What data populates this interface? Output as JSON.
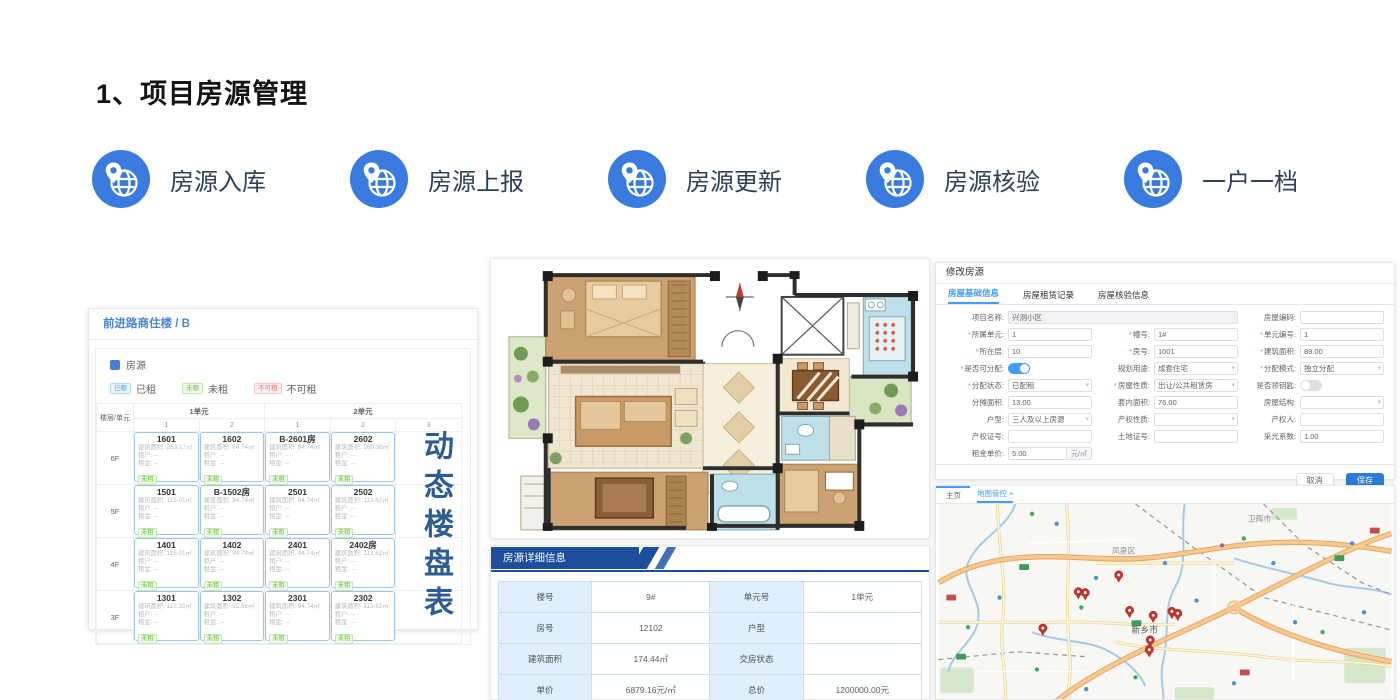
{
  "slide": {
    "title": "1、项目房源管理"
  },
  "features": [
    {
      "label": "房源入库"
    },
    {
      "label": "房源上报"
    },
    {
      "label": "房源更新"
    },
    {
      "label": "房源核验"
    },
    {
      "label": "一户一档"
    }
  ],
  "colors": {
    "accent_blue": "#3a7be0",
    "caption_blue": "#2e5d94",
    "header_blue": "#1d4e9e",
    "active_tab_blue": "#409eff",
    "save_button_blue": "#2a7bd8",
    "pin_red": "#c2342c"
  },
  "building_panel": {
    "title": "前进路商住楼 / B",
    "legend_source": "房源",
    "statuses": [
      {
        "label": "已租",
        "type": "rented"
      },
      {
        "label": "未租",
        "type": "vacant"
      },
      {
        "label": "不可租",
        "type": "unavailable"
      }
    ],
    "corner_label": "楼层/单元",
    "unit_groups": [
      {
        "label": "1单元",
        "cols": [
          "1",
          "2"
        ]
      },
      {
        "label": "2单元",
        "cols": [
          "1",
          "2",
          "3"
        ]
      }
    ],
    "field_labels": {
      "area": "建筑面积:",
      "tenant": "租户:",
      "rent": "租金:",
      "empty": "--",
      "status_badge": "未租"
    },
    "rows": [
      {
        "floor": "6F",
        "rooms": [
          {
            "no": "1601",
            "area": "263.17㎡"
          },
          {
            "no": "1602",
            "area": "94.74㎡"
          },
          {
            "no": "B-2601房",
            "area": "94.74㎡"
          },
          {
            "no": "2602",
            "area": "260.36㎡"
          }
        ]
      },
      {
        "floor": "5F",
        "rooms": [
          {
            "no": "1501",
            "area": "115.01㎡"
          },
          {
            "no": "B-1502房",
            "area": "94.74㎡"
          },
          {
            "no": "2501",
            "area": "94.74㎡"
          },
          {
            "no": "2502",
            "area": "113.62㎡"
          }
        ]
      },
      {
        "floor": "4F",
        "rooms": [
          {
            "no": "1401",
            "area": "115.01㎡"
          },
          {
            "no": "1402",
            "area": "94.74㎡"
          },
          {
            "no": "2401",
            "area": "94.74㎡"
          },
          {
            "no": "2402房",
            "area": "113.62㎡"
          }
        ]
      },
      {
        "floor": "3F",
        "rooms": [
          {
            "no": "1301",
            "area": "113.35㎡"
          },
          {
            "no": "1302",
            "area": "92.56㎡"
          },
          {
            "no": "2301",
            "area": "94.74㎡"
          },
          {
            "no": "2302",
            "area": "113.62㎡"
          }
        ]
      }
    ]
  },
  "vertical_caption": "动态楼盘表",
  "detail_panel": {
    "header": "房源详细信息",
    "rows": [
      [
        {
          "label": "楼号",
          "value": "9#"
        },
        {
          "label": "单元号",
          "value": "1单元"
        }
      ],
      [
        {
          "label": "房号",
          "value": "12102"
        },
        {
          "label": "户型",
          "value": ""
        }
      ],
      [
        {
          "label": "建筑面积",
          "value": "174.44㎡"
        },
        {
          "label": "交房状态",
          "value": ""
        }
      ],
      [
        {
          "label": "单价",
          "value": "6879.16元/㎡"
        },
        {
          "label": "总价",
          "value": "1200000.00元"
        }
      ]
    ]
  },
  "edit_form": {
    "title": "修改房源",
    "tabs": [
      {
        "label": "房屋基础信息",
        "active": true
      },
      {
        "label": "房屋租赁记录",
        "active": false
      },
      {
        "label": "房屋核验信息",
        "active": false
      }
    ],
    "rows": [
      [
        {
          "label": "项目名称",
          "type": "input",
          "value": "兴测小区",
          "disabled": true,
          "wide": true
        },
        {
          "label": "房屋编码",
          "type": "input",
          "value": ""
        }
      ],
      [
        {
          "label": "所属单元",
          "required": true,
          "type": "input",
          "value": "1"
        },
        {
          "label": "幢号",
          "required": true,
          "type": "input",
          "value": "1#"
        },
        {
          "label": "单元编号",
          "required": true,
          "type": "input",
          "value": "1"
        }
      ],
      [
        {
          "label": "所在层",
          "required": true,
          "type": "input",
          "value": "10"
        },
        {
          "label": "房号",
          "required": true,
          "type": "input",
          "value": "1001"
        },
        {
          "label": "建筑面积",
          "required": true,
          "type": "input",
          "value": "89.00"
        }
      ],
      [
        {
          "label": "是否可分配",
          "required": true,
          "type": "toggle",
          "on": true
        },
        {
          "label": "规划用途",
          "type": "select",
          "value": "成套住宅"
        },
        {
          "label": "分配模式",
          "required": true,
          "type": "select",
          "value": "独立分配"
        }
      ],
      [
        {
          "label": "分配状态",
          "required": true,
          "type": "select",
          "value": "已配租"
        },
        {
          "label": "房屋性质",
          "required": true,
          "type": "select",
          "value": "出让/公共租赁房"
        },
        {
          "label": "是否领钥匙",
          "type": "toggle",
          "on": false
        }
      ],
      [
        {
          "label": "分摊面积",
          "type": "input",
          "value": "13.00"
        },
        {
          "label": "套内面积",
          "type": "input",
          "value": "76.00"
        },
        {
          "label": "房屋结构",
          "type": "select",
          "value": ""
        }
      ],
      [
        {
          "label": "户型",
          "type": "select",
          "value": "三人及以上房源"
        },
        {
          "label": "产权性质",
          "type": "select",
          "value": ""
        },
        {
          "label": "产权人",
          "type": "input",
          "value": ""
        }
      ],
      [
        {
          "label": "产权证号",
          "type": "input",
          "value": ""
        },
        {
          "label": "土地证号",
          "type": "input",
          "value": ""
        },
        {
          "label": "采光系数",
          "type": "input",
          "value": "1.00"
        }
      ],
      [
        {
          "label": "租金单价",
          "type": "input",
          "value": "5.00",
          "suffix": "元/㎡"
        }
      ]
    ],
    "buttons": {
      "cancel": "取消",
      "save": "保存"
    }
  },
  "map_panel": {
    "tabs": [
      {
        "label": "主页",
        "active": false
      },
      {
        "label": "地图管控 ×",
        "active": true
      }
    ],
    "city_labels": [
      {
        "text": "凤泉区",
        "x": 176,
        "y": 50
      },
      {
        "text": "卫辉市",
        "x": 314,
        "y": 18
      },
      {
        "text": "新乡市",
        "x": 196,
        "y": 131
      }
    ],
    "pins": [
      {
        "x": 183,
        "y": 80
      },
      {
        "x": 142,
        "y": 97
      },
      {
        "x": 149,
        "y": 98
      },
      {
        "x": 194,
        "y": 116
      },
      {
        "x": 218,
        "y": 121
      },
      {
        "x": 237,
        "y": 117
      },
      {
        "x": 243,
        "y": 119
      },
      {
        "x": 106,
        "y": 134
      },
      {
        "x": 215,
        "y": 146
      },
      {
        "x": 214,
        "y": 156
      }
    ]
  }
}
